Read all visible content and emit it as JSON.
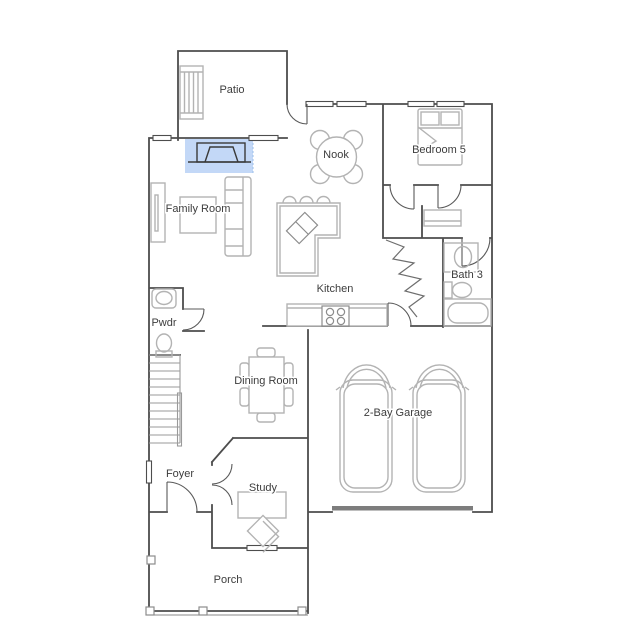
{
  "plan": {
    "title": "First Floor Plan",
    "rooms": [
      {
        "name": "Patio"
      },
      {
        "name": "Nook"
      },
      {
        "name": "Bedroom 5"
      },
      {
        "name": "Family Room"
      },
      {
        "name": "Bath 3"
      },
      {
        "name": "Kitchen"
      },
      {
        "name": "Pwdr"
      },
      {
        "name": "Dining Room"
      },
      {
        "name": "2-Bay Garage"
      },
      {
        "name": "Foyer"
      },
      {
        "name": "Study"
      },
      {
        "name": "Porch"
      }
    ],
    "selection": {
      "item": "fireplace",
      "highlight_color": "#c3d8f7",
      "highlight_edge_color": "#9dbfea"
    },
    "fixtures": [
      "patio-bench",
      "nook-table",
      "bed",
      "closet-shelf",
      "bath-sink",
      "bath-toilet",
      "bath-tub",
      "kitchen-island",
      "island-sink",
      "bar-stools",
      "cooktop",
      "pwdr-sink",
      "pwdr-toilet",
      "dining-table",
      "car",
      "car",
      "stairs",
      "sofa",
      "tv-console",
      "coffee-table",
      "desk",
      "desk-chair",
      "porch-posts",
      "garage-door",
      "fireplace"
    ]
  },
  "colors": {
    "wall": "#4d4d4d",
    "furniture": "#b3b3b3",
    "background": "#ffffff",
    "label_text": "#3d3d3d"
  }
}
